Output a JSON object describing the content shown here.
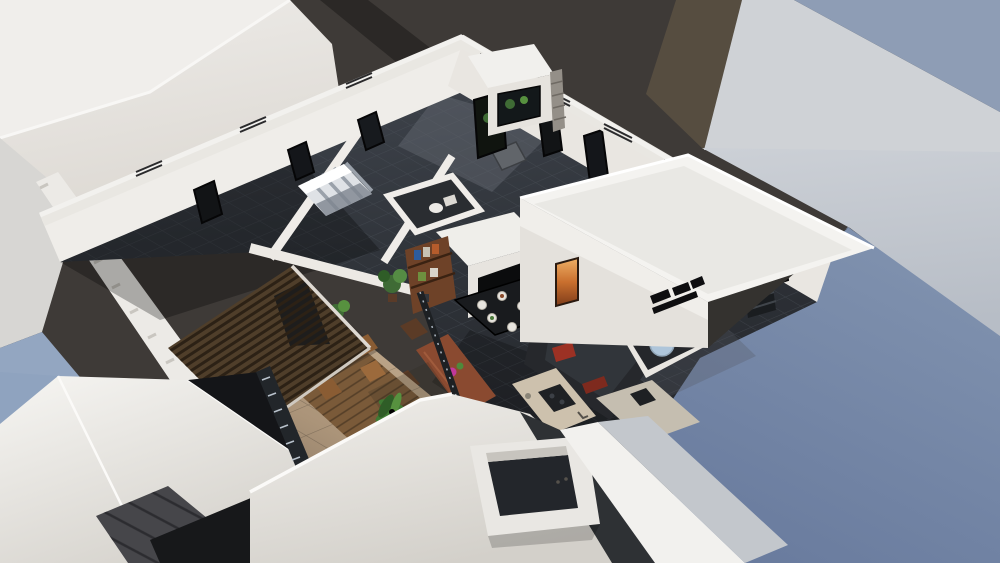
{
  "scene": {
    "type": "architectural-3d-render",
    "description": "Aerial cutaway 3D rendering of a penthouse apartment interior surrounded by white rooftops, a dark street and a blue-grey neighbouring roof",
    "objects": [
      "white rooftop planes",
      "asphalt street",
      "neighbouring building blue-grey roof",
      "penthouse cutaway apartment",
      "perimeter walls with guard railings",
      "windows",
      "bedroom with striped bed",
      "bathroom fixtures",
      "hallway door",
      "bookshelf",
      "potted plants",
      "L-shaped sofa with cushions",
      "coffee table with plates",
      "round pouf",
      "wooden dining table with flowers",
      "kitchen island with cooktop",
      "fireplace glow strip",
      "black wall logo",
      "rooftop box volume",
      "spiral staircase",
      "barbecue pad",
      "glass balustrade",
      "stone terrace",
      "outdoor wooden chairs and table",
      "palm plant",
      "sun loungers",
      "wooden deck",
      "slatted pergola roof",
      "stairwell opening",
      "dark metal roof panels"
    ]
  },
  "palette": {
    "asphalt": "#3e3a37",
    "asphalt_dark": "#2b2826",
    "olive_roof": "#564d40",
    "neighbor_band": "#cfd2d6",
    "neighbor_blue": "#8e9db5",
    "white_lit": "#f2f1ee",
    "white_face": "#e4e1dc",
    "left_gray": "#d7d6d3",
    "left_blue": "#93a6c1",
    "tile_floor": "#33373d",
    "stone": "#bfa98d",
    "pergola_wood": "#4f3e2a",
    "deck_wood": "#7a5a39",
    "sofa": "#26282c",
    "cushion_green": "#3e7b4c",
    "cushion_red": "#9c3124",
    "wood_table": "#8a4a30",
    "shelf_wood": "#6e4228",
    "island": "#cdc1ad",
    "cooktop": "#1f2124",
    "plant": "#3f6b35",
    "stair_blue": "#aec5da",
    "window_dark": "#121416",
    "door_gray": "#61656a",
    "panel_dark": "#46464a",
    "roof_black": "#17181a"
  }
}
